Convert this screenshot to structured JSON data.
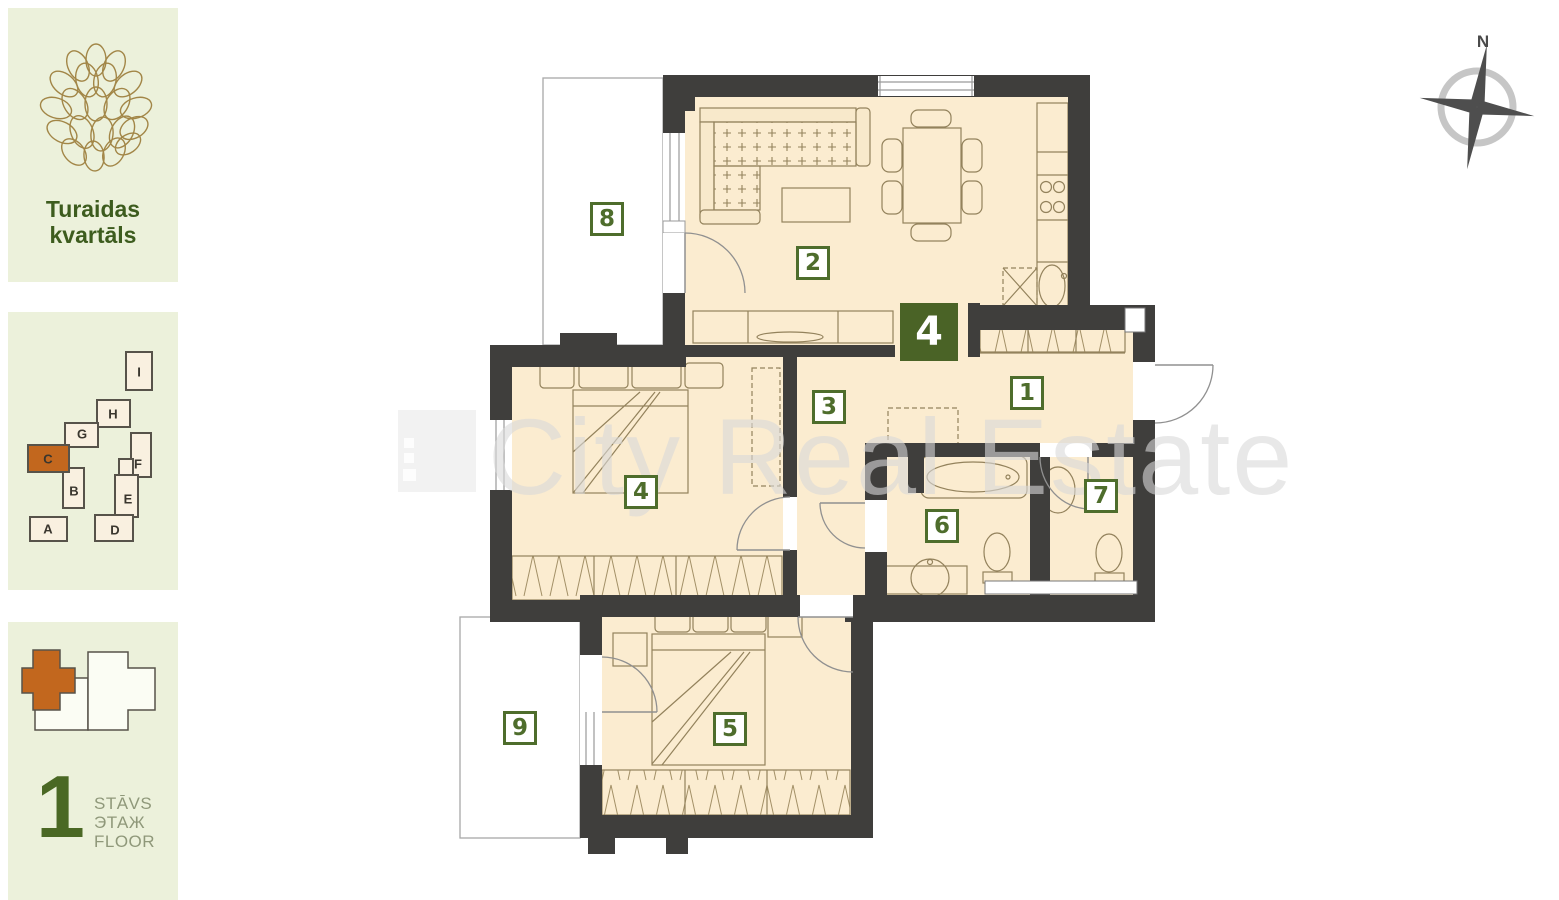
{
  "sidebar": {
    "project": {
      "title": "Turaidas kvartāls"
    },
    "site_map": {
      "buildings": [
        {
          "label": "A",
          "highlighted": false
        },
        {
          "label": "B",
          "highlighted": false
        },
        {
          "label": "C",
          "highlighted": true
        },
        {
          "label": "D",
          "highlighted": false
        },
        {
          "label": "E",
          "highlighted": false
        },
        {
          "label": "F",
          "highlighted": false
        },
        {
          "label": "G",
          "highlighted": false
        },
        {
          "label": "H",
          "highlighted": false
        },
        {
          "label": "I",
          "highlighted": false
        }
      ]
    },
    "floor_indicator": {
      "number": "1",
      "labels": [
        "STĀVS",
        "ЭТАЖ",
        "FLOOR"
      ]
    }
  },
  "plan": {
    "apartment_number": "4",
    "compass_label": "N",
    "room_labels": [
      "1",
      "2",
      "3",
      "4",
      "5",
      "6",
      "7",
      "8",
      "9"
    ]
  },
  "watermark": {
    "text": "City Real Estate"
  },
  "colors": {
    "accent_green": "#4e6d2c",
    "badge_green_bg": "#4a6326",
    "highlight_orange": "#c2671e",
    "wall": "#3f3e3c",
    "floor": "#fbecd0",
    "panel_bg": "#ecf1db"
  }
}
